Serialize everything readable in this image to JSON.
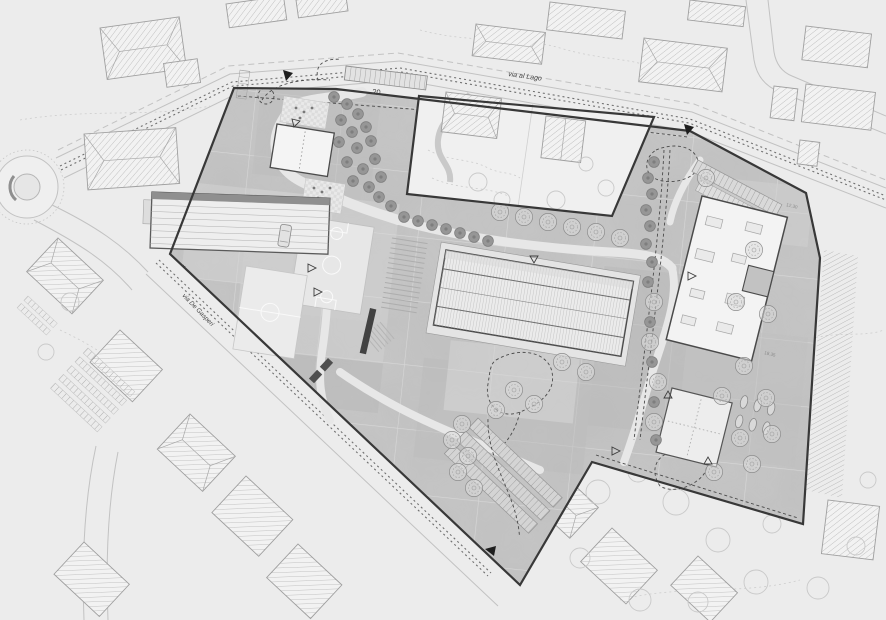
{
  "title": "Architectural site plan — school campus masterplan",
  "labels": {
    "street_top": "via al Lago",
    "street_left": "via De Gasperi",
    "parking_count": "20",
    "dim_small": "3",
    "level_upper": "12.30",
    "level_lower": "18.35"
  },
  "palette": {
    "background": "#ececec",
    "site_fill": "#c7c7c7",
    "new_building_fill": "#f3f3f3",
    "existing_building_fill": "#f2f2f2",
    "boundary": "#383838",
    "tree_dark": "#969696",
    "line_light": "#c2c2c2"
  },
  "features": [
    "perimeter site boundary with entrance arrows",
    "via al Lago with bike-lane ladder markings",
    "secondary road with roadside parking rows",
    "roundabout",
    "existing houses with hatched hip roofs",
    "long sports hall with ribbed roof",
    "flat-roof school buildings with skylights",
    "basketball and mini football courts",
    "grand stairs and dark ramp wall",
    "tree-lined central promenade",
    "serpentine footpaths and dashed play loops",
    "parking strip of 20 stalls",
    "pavilion with bike-stand ovals",
    "mottled gray paving parcels"
  ]
}
